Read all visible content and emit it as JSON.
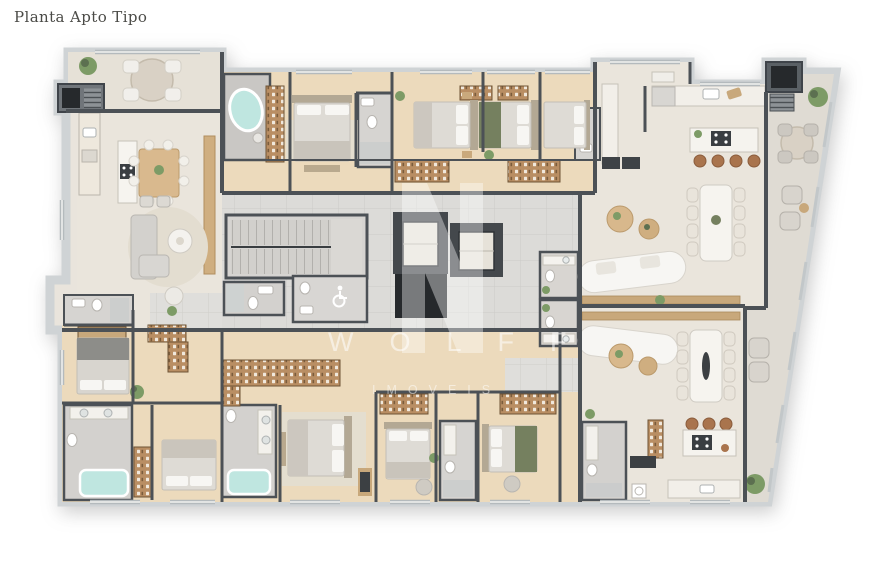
{
  "page": {
    "title": "Planta Apto Tipo"
  },
  "watermark": {
    "brand": "WOLFF",
    "tagline": "IMOVEIS"
  },
  "palette": {
    "background": "#ffffff",
    "title_text": "#4b4b47",
    "wall": "#4c5156",
    "wall_casing": "#cfd3d5",
    "floor_main": "#eae5dc",
    "floor_wood": "#ecdabc",
    "floor_tile": "#dcdbd8",
    "floor_terrace": "#e0dcd4",
    "floor_bath": "#d2d0cd",
    "water": "#bfe6e0",
    "shaft_dark": "#26292c",
    "furniture_wood": "#d9b98e",
    "closet_wood": "#b98e63",
    "stool_leather": "#a9744d",
    "greenery": "#7d9b66",
    "watermark_text": "rgba(255,255,255,0.55)"
  }
}
